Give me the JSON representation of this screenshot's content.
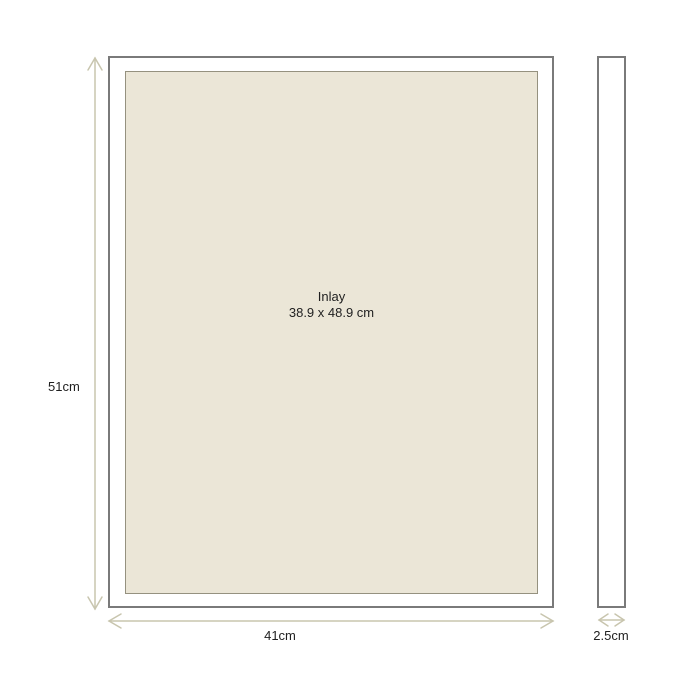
{
  "diagram": {
    "front_view": {
      "inlay_label": "Inlay",
      "inlay_size": "38.9 x 48.9 cm",
      "height_label": "51cm",
      "width_label": "41cm"
    },
    "side_view": {
      "depth_label": "2.5cm"
    },
    "colors": {
      "background": "#ffffff",
      "frame_border": "#7a7a7a",
      "inlay_fill": "#ebe6d7",
      "inlay_border": "#95917f",
      "dimension_line": "#c8c5ae",
      "text": "#1f1f1f"
    }
  }
}
